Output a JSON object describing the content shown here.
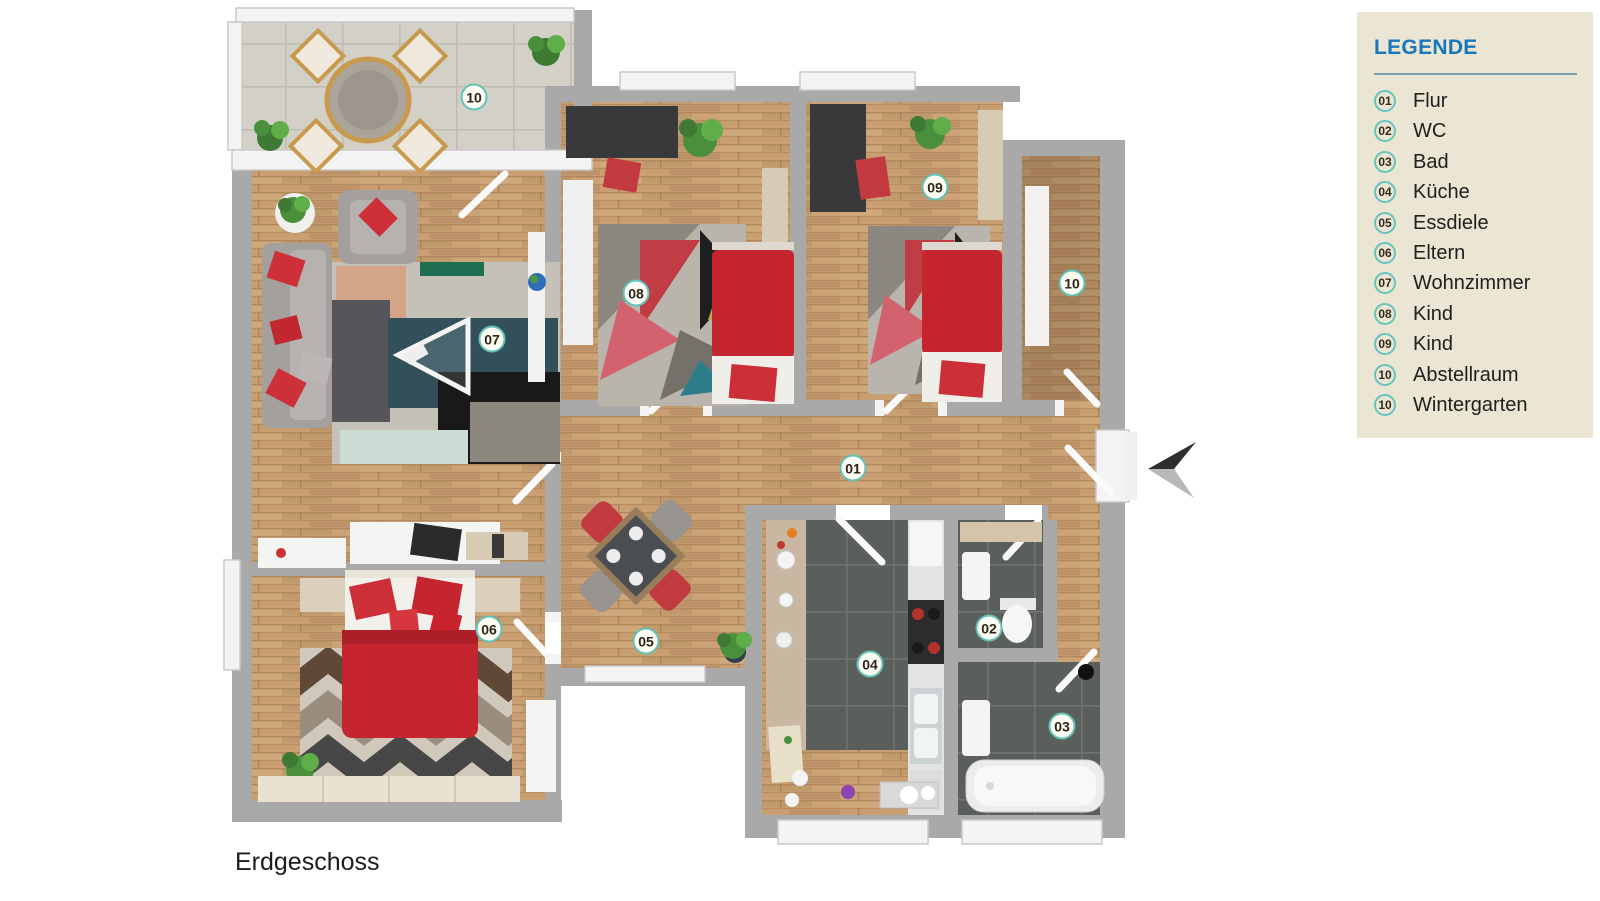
{
  "floor_label": "Erdgeschoss",
  "legend": {
    "title": "LEGENDE",
    "items": [
      {
        "num": "01",
        "label": "Flur"
      },
      {
        "num": "02",
        "label": "WC"
      },
      {
        "num": "03",
        "label": "Bad"
      },
      {
        "num": "04",
        "label": "Küche"
      },
      {
        "num": "05",
        "label": "Essdiele"
      },
      {
        "num": "06",
        "label": "Eltern"
      },
      {
        "num": "07",
        "label": "Wohnzimmer"
      },
      {
        "num": "08",
        "label": "Kind"
      },
      {
        "num": "09",
        "label": "Kind"
      },
      {
        "num": "10",
        "label": "Abstellraum"
      },
      {
        "num": "10",
        "label": "Wintergarten"
      }
    ]
  },
  "room_badges": [
    {
      "num": "10",
      "room": "wintergarten",
      "x": 474,
      "y": 97
    },
    {
      "num": "07",
      "room": "wohnzimmer",
      "x": 492,
      "y": 339
    },
    {
      "num": "08",
      "room": "kind-1",
      "x": 636,
      "y": 293
    },
    {
      "num": "09",
      "room": "kind-2",
      "x": 935,
      "y": 187
    },
    {
      "num": "10",
      "room": "abstellraum",
      "x": 1072,
      "y": 283
    },
    {
      "num": "01",
      "room": "flur",
      "x": 853,
      "y": 468
    },
    {
      "num": "05",
      "room": "essdiele",
      "x": 646,
      "y": 641
    },
    {
      "num": "06",
      "room": "eltern",
      "x": 489,
      "y": 629
    },
    {
      "num": "04",
      "room": "kueche",
      "x": 870,
      "y": 664
    },
    {
      "num": "02",
      "room": "wc",
      "x": 989,
      "y": 628
    },
    {
      "num": "03",
      "room": "bad",
      "x": 1062,
      "y": 726
    }
  ],
  "colors": {
    "legend_bg": "#ebe5d4",
    "legend_title_blue": "#1877ba",
    "badge_ring_teal": "#63c2b5",
    "badge_text": "#2f2517",
    "wall_gray": "#a9a9a9",
    "wood_floor": "#c6a176",
    "dark_tile": "#5b5f5c",
    "terrace_tile": "#d3d0c7",
    "accent_red": "#c4252f"
  }
}
